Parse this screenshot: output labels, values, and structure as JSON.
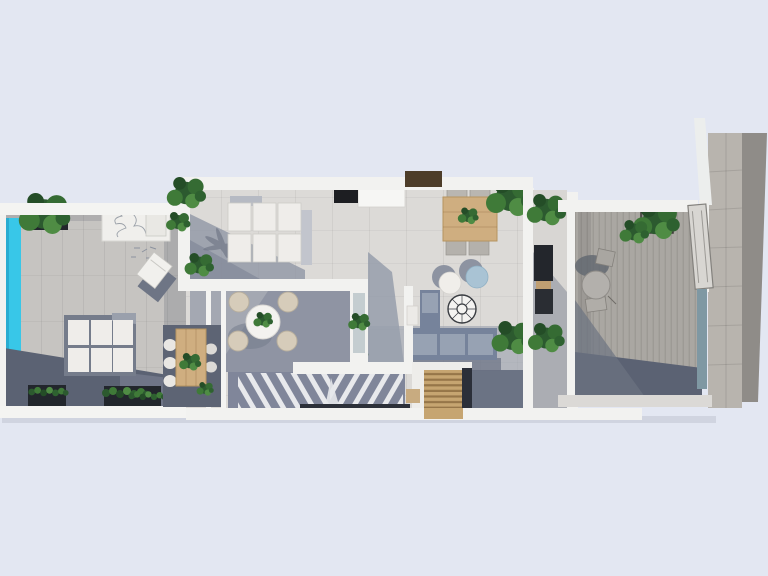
{
  "title": "Top-down 3D architectural floor plan render",
  "palette": {
    "background": "#e3e7f2",
    "wall_white": "#f2f2f0",
    "terrace_floor": "#c6c4c1",
    "interior_floor": "#dcdad7",
    "patio_floor": "#a4a8b2",
    "deck_floor": "#aaa7a2",
    "stone_path": "#b8b4ae",
    "stone_dark": "#8f8c88",
    "pool_water": "#38c7e8",
    "shadow_dark": "#5b6273",
    "shadow_mid": "#8b91a1",
    "wood_light": "#cfae80",
    "wood_slat": "#c6a571",
    "pergola_brown": "#4d3d29",
    "tv_black": "#1d1e22",
    "sofa_gray_blue": "#76839b",
    "sofa_cushion": "#97a2b3",
    "pouf_blue": "#a9c3d4",
    "cushion_white": "#efedea",
    "chair_beige": "#d6ccba",
    "plant_green": "#3f7a38",
    "plant_dark": "#27532c",
    "planter_dark": "#22262c",
    "glass_teal": "#7f98a3",
    "stair_floor": "#80869a"
  },
  "scene": {
    "areas": [
      {
        "id": "left-terrace",
        "label": "pool terrace"
      },
      {
        "id": "swimming-pool",
        "label": "lap pool"
      },
      {
        "id": "living-room",
        "label": "open-plan living room"
      },
      {
        "id": "patio",
        "label": "covered patio with round dining set"
      },
      {
        "id": "outdoor-dining",
        "label": "wooden dining table nook"
      },
      {
        "id": "staircase",
        "label": "switchback staircase"
      },
      {
        "id": "family-room",
        "label": "lounge with sofa and poufs"
      },
      {
        "id": "corridor",
        "label": "utility corridor"
      },
      {
        "id": "right-terrace",
        "label": "entry terrace"
      },
      {
        "id": "stone-path",
        "label": "side stone path"
      }
    ],
    "objects": [
      {
        "id": "outdoor-sectional-sofa",
        "label": "white outdoor sectional"
      },
      {
        "id": "sun-lounger",
        "label": "sun lounger"
      },
      {
        "id": "white-sofa-set",
        "label": "white modular sofa pair"
      },
      {
        "id": "tv",
        "label": "wall TV"
      },
      {
        "id": "pergola-beam",
        "label": "dark wood pergola"
      },
      {
        "id": "round-dining-table",
        "label": "round table with 4 rattan chairs"
      },
      {
        "id": "wood-dining-table-left",
        "label": "6-seat wooden table"
      },
      {
        "id": "wood-dining-table-center",
        "label": "4-seat wooden table"
      },
      {
        "id": "poufs",
        "label": "white and blue round poufs"
      },
      {
        "id": "hanging-chair",
        "label": "round spoke chair"
      },
      {
        "id": "sectional-sofa",
        "label": "gray-blue sectional sofa"
      },
      {
        "id": "wood-stairs",
        "label": "timber entry steps"
      },
      {
        "id": "bistro-set",
        "label": "round bistro table with 2 chairs"
      },
      {
        "id": "entry-door",
        "label": "open entry door"
      },
      {
        "id": "planters",
        "label": "dark planter boxes with greenery"
      }
    ]
  }
}
